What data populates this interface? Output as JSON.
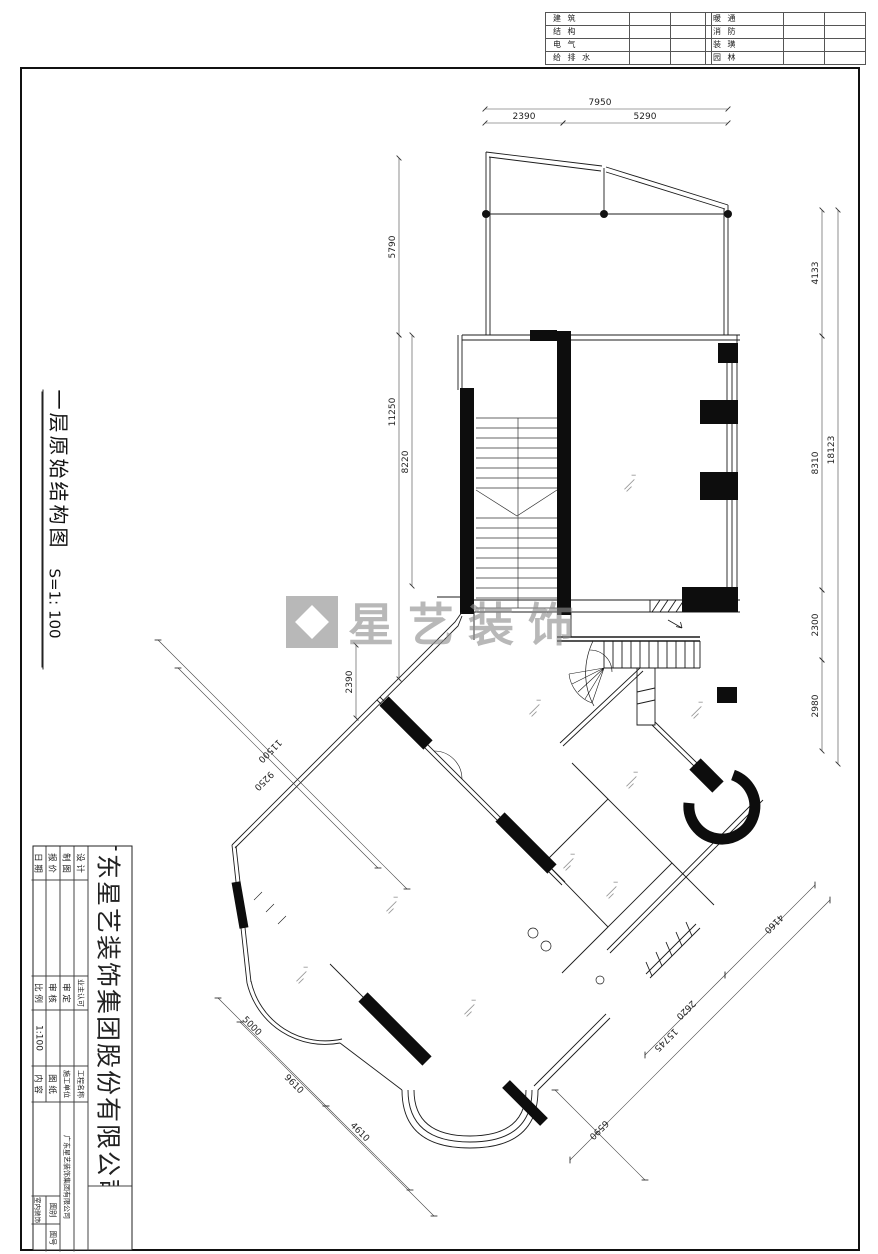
{
  "discipline_table": {
    "left": [
      "建 筑",
      "结 构",
      "电 气",
      "给 排 水"
    ],
    "right": [
      "暖 通",
      "消 防",
      "装 璜",
      "园 林"
    ]
  },
  "side_title": {
    "name": "一层原始结构图",
    "scale": "S=1: 100"
  },
  "watermark": {
    "text": "星艺装饰"
  },
  "title_block": {
    "company": "广东星艺装饰集团股份有限公司",
    "col_a": [
      "设 计",
      "制 图",
      "报 价",
      "日 期"
    ],
    "col_c": [
      "业主认可",
      "审 定",
      "审 核",
      "比 例"
    ],
    "scale_value": "1:100",
    "col_e": [
      "工程名称",
      "施工单位",
      "图 纸",
      "内 容"
    ],
    "builder_value": "广东星艺装饰集团有限公司",
    "category_label": "图别",
    "number_label": "图号",
    "category_value": "室内装饰"
  },
  "dimensions": [
    {
      "label": "7950",
      "x1": 485,
      "y1": 109,
      "x2": 728,
      "y2": 109,
      "lx": 600,
      "ly": 105,
      "rot": 0
    },
    {
      "label": "2390",
      "x1": 485,
      "y1": 123,
      "x2": 563,
      "y2": 123,
      "lx": 524,
      "ly": 119,
      "rot": 0
    },
    {
      "label": "5290",
      "x1": 563,
      "y1": 123,
      "x2": 728,
      "y2": 123,
      "lx": 645,
      "ly": 119,
      "rot": 0
    },
    {
      "label": "4133",
      "x1": 822,
      "y1": 210,
      "x2": 822,
      "y2": 336,
      "lx": 818,
      "ly": 273,
      "rot": -90
    },
    {
      "label": "8310",
      "x1": 822,
      "y1": 336,
      "x2": 822,
      "y2": 590,
      "lx": 818,
      "ly": 463,
      "rot": -90
    },
    {
      "label": "2300",
      "x1": 822,
      "y1": 590,
      "x2": 822,
      "y2": 660,
      "lx": 818,
      "ly": 625,
      "rot": -90
    },
    {
      "label": "2980",
      "x1": 822,
      "y1": 660,
      "x2": 822,
      "y2": 751,
      "lx": 818,
      "ly": 706,
      "rot": -90
    },
    {
      "label": "18123",
      "x1": 838,
      "y1": 210,
      "x2": 838,
      "y2": 764,
      "lx": 834,
      "ly": 450,
      "rot": -90
    },
    {
      "label": "5790",
      "x1": 399,
      "y1": 158,
      "x2": 399,
      "y2": 335,
      "lx": 395,
      "ly": 247,
      "rot": -90
    },
    {
      "label": "8220",
      "x1": 412,
      "y1": 335,
      "x2": 412,
      "y2": 586,
      "lx": 408,
      "ly": 462,
      "rot": -90
    },
    {
      "label": "11250",
      "x1": 399,
      "y1": 335,
      "x2": 399,
      "y2": 679,
      "lx": 395,
      "ly": 412,
      "rot": -90
    },
    {
      "label": "2390",
      "x1": 356,
      "y1": 645,
      "x2": 356,
      "y2": 718,
      "lx": 352,
      "ly": 682,
      "rot": -90
    },
    {
      "label": "11500",
      "x1": 158,
      "y1": 640,
      "x2": 407,
      "y2": 889,
      "lx": 268,
      "ly": 749,
      "rot": 135
    },
    {
      "label": "9250",
      "x1": 178,
      "y1": 668,
      "x2": 378,
      "y2": 868,
      "lx": 262,
      "ly": 779,
      "rot": 135
    },
    {
      "label": "5000",
      "x1": 218,
      "y1": 998,
      "x2": 326,
      "y2": 1106,
      "lx": 250,
      "ly": 1028,
      "rot": 45
    },
    {
      "label": "4610",
      "x1": 326,
      "y1": 1106,
      "x2": 410,
      "y2": 1190,
      "lx": 358,
      "ly": 1134,
      "rot": 45
    },
    {
      "label": "9610",
      "x1": 240,
      "y1": 1022,
      "x2": 434,
      "y2": 1216,
      "lx": 292,
      "ly": 1086,
      "rot": 45
    },
    {
      "label": "4160",
      "x1": 815,
      "y1": 885,
      "x2": 725,
      "y2": 975,
      "lx": 772,
      "ly": 922,
      "rot": 135
    },
    {
      "label": "2620",
      "x1": 725,
      "y1": 975,
      "x2": 645,
      "y2": 1055,
      "lx": 684,
      "ly": 1008,
      "rot": 135
    },
    {
      "label": "15745",
      "x1": 830,
      "y1": 900,
      "x2": 570,
      "y2": 1160,
      "lx": 664,
      "ly": 1038,
      "rot": 135
    },
    {
      "label": "6590",
      "x1": 555,
      "y1": 1090,
      "x2": 645,
      "y2": 1180,
      "lx": 597,
      "ly": 1128,
      "rot": 135
    }
  ]
}
